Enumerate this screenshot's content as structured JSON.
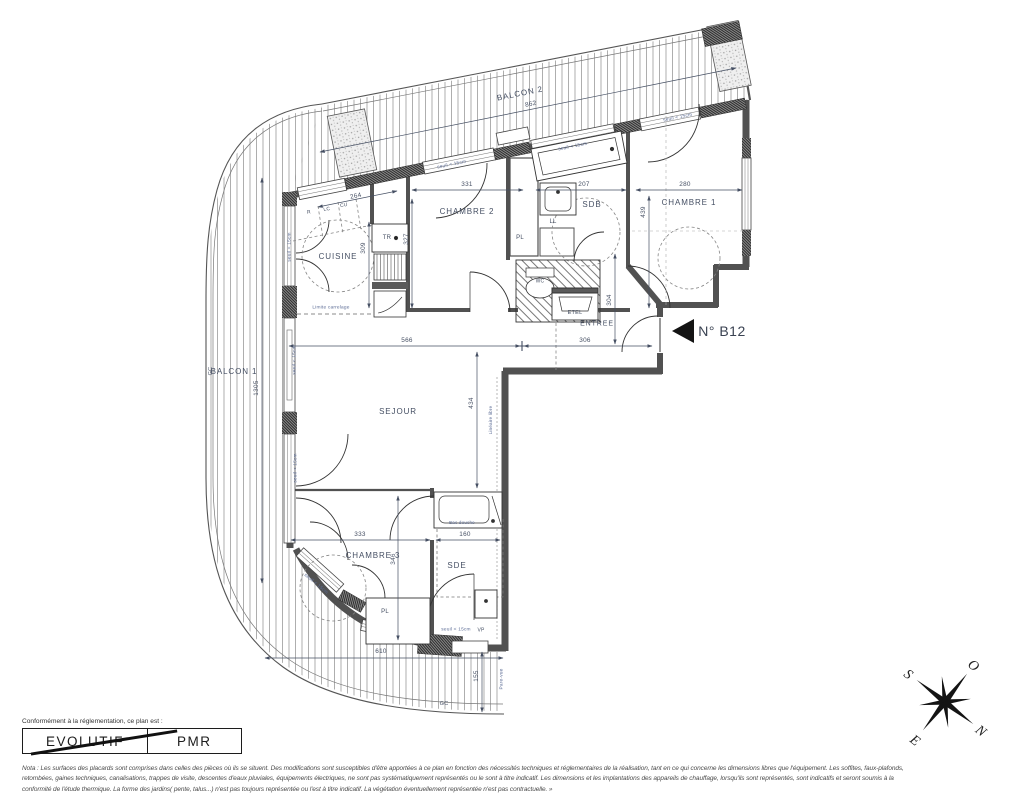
{
  "rooms": {
    "balcon1": "BALCON 1",
    "balcon2": "BALCON 2",
    "cuisine": "CUISINE",
    "chambre1": "CHAMBRE 1",
    "chambre2": "CHAMBRE 2",
    "chambre3": "CHAMBRE 3",
    "sejour": "SEJOUR",
    "sdb": "SDB",
    "sde": "SDE",
    "entree": "ENTREE",
    "etel": "ETEL"
  },
  "unit": {
    "number": "N° B12"
  },
  "dims": {
    "862": "862",
    "1305": "1305",
    "264": "264",
    "331": "331",
    "207": "207",
    "280": "280",
    "439": "439",
    "327": "327",
    "309": "309",
    "566": "566",
    "306": "306",
    "434": "434",
    "304": "304",
    "333": "333",
    "160": "160",
    "346": "346",
    "610": "610",
    "155": "155"
  },
  "labels": {
    "r": "R",
    "lc": "LC",
    "cu": "CU",
    "tr": "TR",
    "pl": "PL",
    "ll": "LL",
    "vp": "VP",
    "gc": "GC",
    "wc": "WC",
    "etel": "ETEL"
  },
  "annotations": {
    "seuil": "seuil < 15cm",
    "limite": "Limite carrelage",
    "lineaire": "Linéaire libre",
    "pare_vue": "Pare-vue",
    "bac_douche": "Bac douche"
  },
  "compass": {
    "n": "N",
    "s": "S",
    "e": "E",
    "o": "O"
  },
  "legend": {
    "title": "Conformément à la réglementation, ce plan est :",
    "evolutif": "EVOLUTIF",
    "pmr": "PMR"
  },
  "footer": {
    "nota_lines": [
      "Nota : Les surfaces des placards sont comprises dans celles des pièces où ils se situent. Des modifications sont susceptibles d'être apportées à ce plan en fonction des nécessités techniques et réglementaires de la réalisation, tant en ce qui concerne les dimensions libres que l'équipement.  Les soffites, faux-plafonds,",
      "retombées, gaines techniques, canalisations, trappes de visite, descentes d'eaux pluviales, équipements électriques, ne sont pas systématiquement représentés ou le sont à titre indicatif. Les dimensions et les implantations des appareils de chauffage, lorsqu'ils sont représentés, sont indicatifs et seront soumis à la",
      "conformité de l'étude thermique. La forme des jardins( pente, talus...) n'est pas toujours représentée ou l'est à titre indicatif. La végétation éventuellement représentée n'est pas contractuelle. »"
    ]
  }
}
